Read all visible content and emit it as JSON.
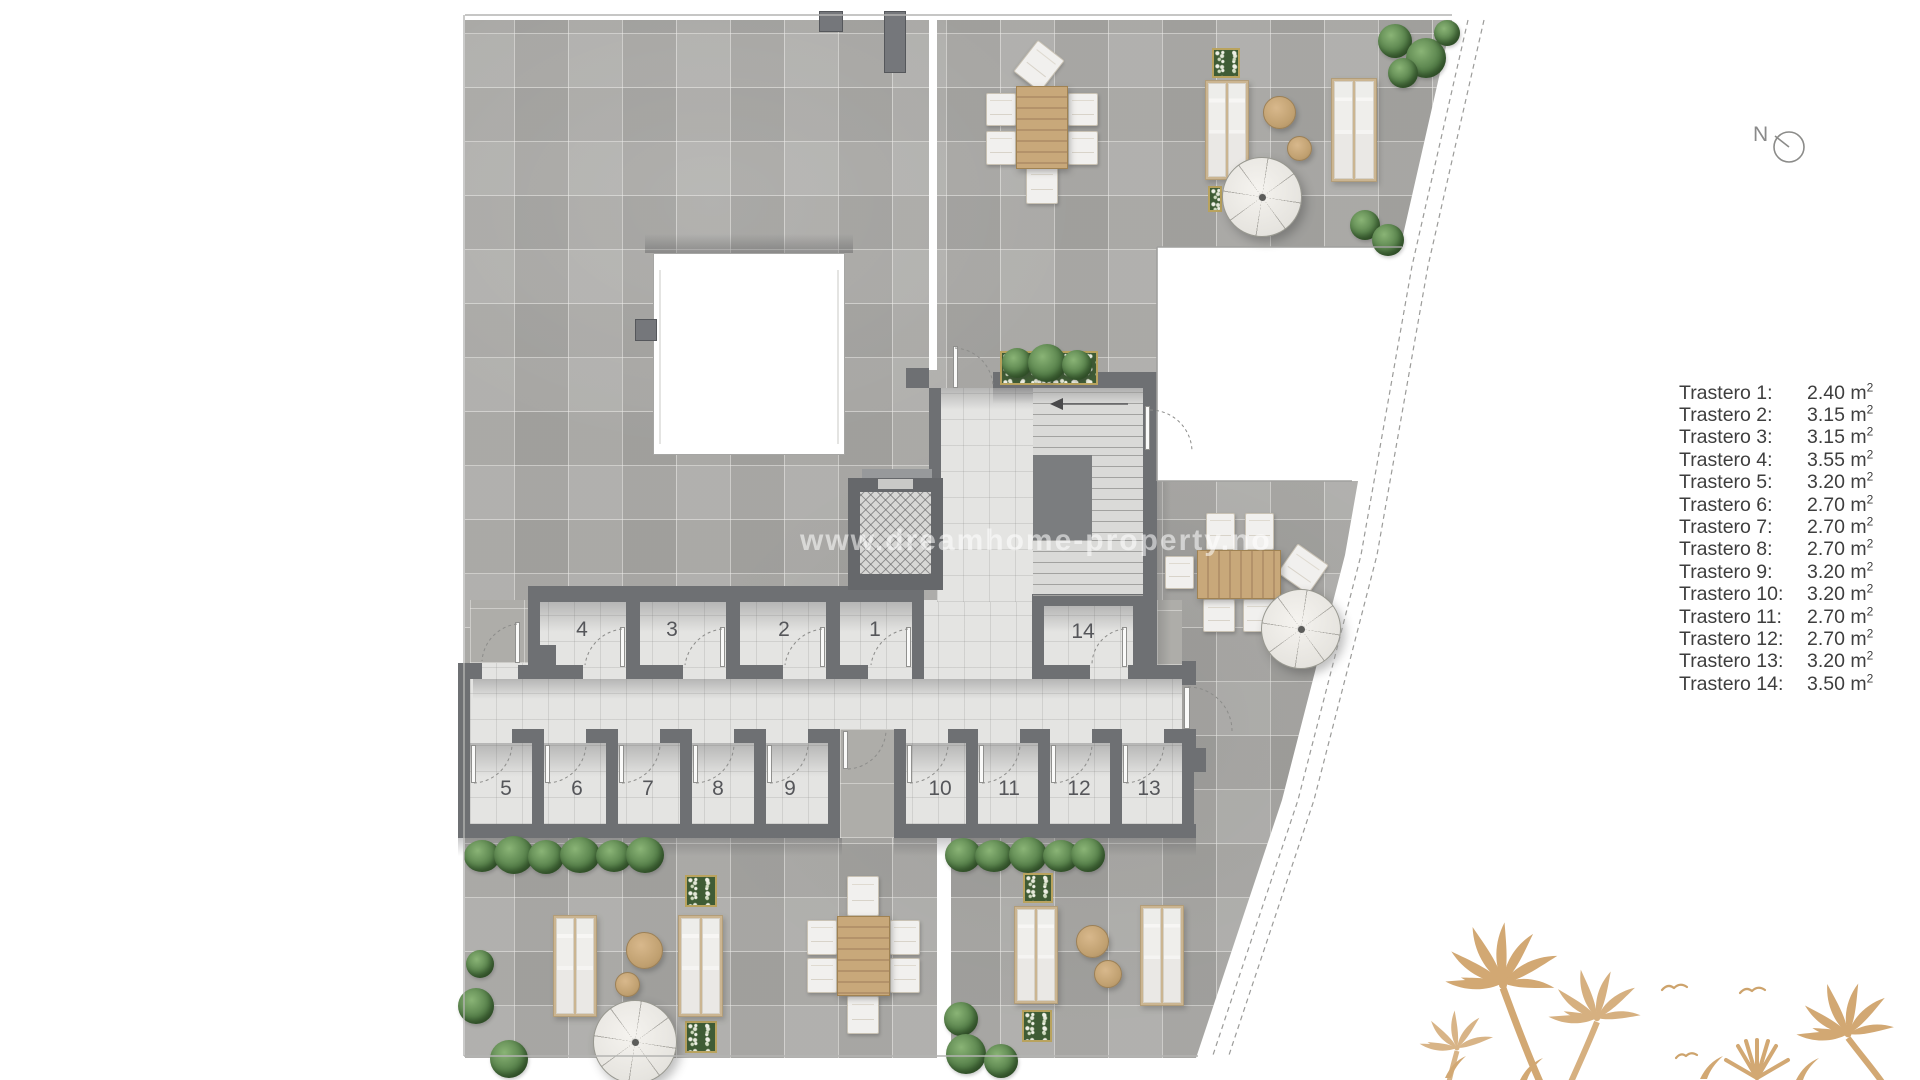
{
  "legend": {
    "unit_base": "m",
    "items": [
      {
        "label": "Trastero 1:",
        "area": "2.40 m",
        "sup": "2"
      },
      {
        "label": "Trastero 2:",
        "area": "3.15 m",
        "sup": "2"
      },
      {
        "label": "Trastero 3:",
        "area": "3.15 m",
        "sup": "2"
      },
      {
        "label": "Trastero 4:",
        "area": "3.55 m",
        "sup": "2"
      },
      {
        "label": "Trastero 5:",
        "area": "3.20 m",
        "sup": "2"
      },
      {
        "label": "Trastero 6:",
        "area": "2.70 m",
        "sup": "2"
      },
      {
        "label": "Trastero 7:",
        "area": "2.70 m",
        "sup": "2"
      },
      {
        "label": "Trastero 8:",
        "area": "2.70 m",
        "sup": "2"
      },
      {
        "label": "Trastero 9:",
        "area": "3.20 m",
        "sup": "2"
      },
      {
        "label": "Trastero 10:",
        "area": "3.20 m",
        "sup": "2"
      },
      {
        "label": "Trastero 11:",
        "area": "2.70 m",
        "sup": "2"
      },
      {
        "label": "Trastero 12:",
        "area": "2.70 m",
        "sup": "2"
      },
      {
        "label": "Trastero 13:",
        "area": "3.20 m",
        "sup": "2"
      },
      {
        "label": "Trastero 14:",
        "area": "3.50 m",
        "sup": "2"
      }
    ]
  },
  "rooms": {
    "n1": "1",
    "n2": "2",
    "n3": "3",
    "n4": "4",
    "n5": "5",
    "n6": "6",
    "n7": "7",
    "n8": "8",
    "n9": "9",
    "n10": "10",
    "n11": "11",
    "n12": "12",
    "n13": "13",
    "n14": "14"
  },
  "compass": {
    "label": "N"
  },
  "watermark": {
    "text": "www.dreamhome-property.no"
  },
  "colors": {
    "wall": "#6e7073",
    "terrace_tile": "#abaaa7",
    "indoor_tile": "#e4e4e2",
    "wood": "#c2a173",
    "palm": "#d2a873",
    "legend_text": "#3e3e3e"
  }
}
